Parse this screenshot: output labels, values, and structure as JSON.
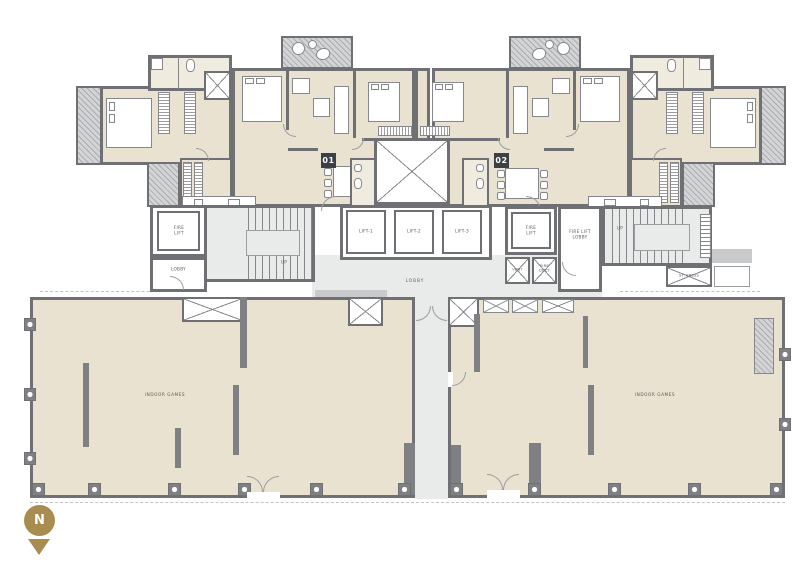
{
  "colors": {
    "wall": "#6E7073",
    "line": "#85878A",
    "cream": "#E9E2D0",
    "cream2": "#F0EBDF",
    "gray": "#E9EAEA",
    "grayMed": "#C9CACC",
    "badgeBg": "#3B4045",
    "badgeFg": "#FFFFFF",
    "gold": "#A98C50",
    "doorline": "#9B9DA0",
    "dash": "#C0C2C4",
    "text": "#56585C"
  },
  "units": [
    {
      "badge": "01"
    },
    {
      "badge": "02"
    }
  ],
  "lifts": [
    "LIFT-1",
    "LIFT-2",
    "LIFT-3"
  ],
  "core": {
    "fire_lift": "FIRE LIFT",
    "lobby_small": "LOBBY",
    "fire_lift_lobby": "FIRE LIFT LOBBY",
    "vent": "VENT",
    "fire_duct": "FIRE DUCT",
    "st_press": "ST. PRESS",
    "up": "UP",
    "main_lobby": "LOBBY"
  },
  "amenities": [
    {
      "name": "INDOOR GAMES"
    },
    {
      "name": "INDOOR GAMES"
    }
  ],
  "compass": {
    "north": "N"
  }
}
